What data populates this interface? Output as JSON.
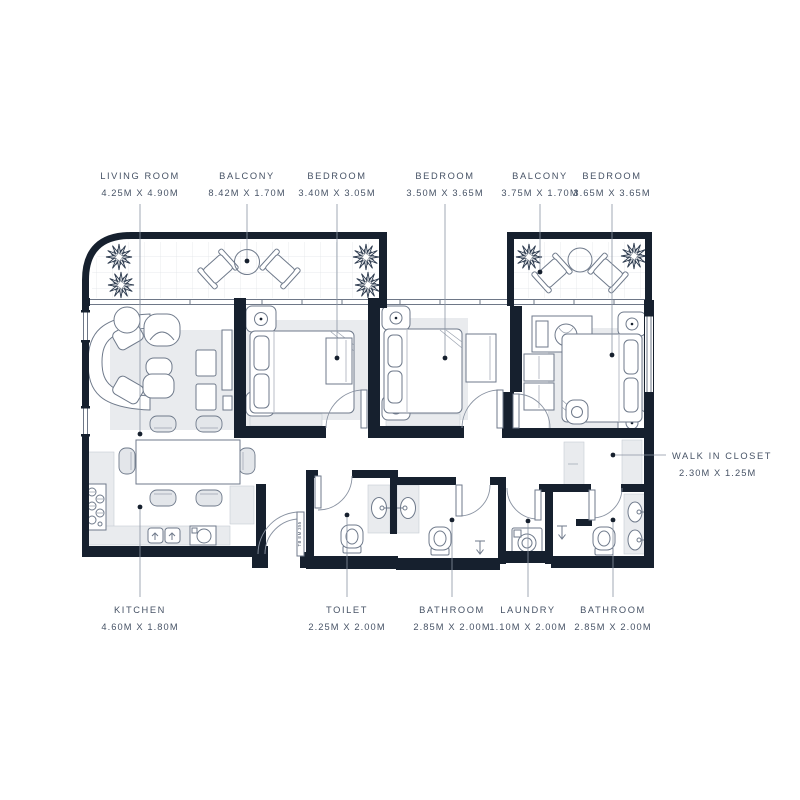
{
  "labels": {
    "top": [
      {
        "name": "LIVING ROOM",
        "dims": "4.25M X 4.90M"
      },
      {
        "name": "BALCONY",
        "dims": "8.42M X 1.70M"
      },
      {
        "name": "BEDROOM",
        "dims": "3.40M X 3.05M"
      },
      {
        "name": "BEDROOM",
        "dims": "3.50M X 3.65M"
      },
      {
        "name": "BALCONY",
        "dims": "3.75M X 1.70M"
      },
      {
        "name": "BEDROOM",
        "dims": "3.65M X 3.65M"
      }
    ],
    "bottom": [
      {
        "name": "KITCHEN",
        "dims": "4.60M X 1.80M"
      },
      {
        "name": "TOILET",
        "dims": "2.25M X 2.00M"
      },
      {
        "name": "BATHROOM",
        "dims": "2.85M X 2.00M"
      },
      {
        "name": "LAUNDRY",
        "dims": "1.10M X 2.00M"
      },
      {
        "name": "BATHROOM",
        "dims": "2.85M X 2.00M"
      }
    ],
    "side": [
      {
        "name": "WALK IN CLOSET",
        "dims": "2.30M X 1.25M"
      }
    ],
    "entry_door_tag": "TB EM 355"
  },
  "colors": {
    "wall": "#16202E",
    "text": "#475366",
    "line": "#7A8494",
    "light_fill": "#E9EBEE"
  }
}
